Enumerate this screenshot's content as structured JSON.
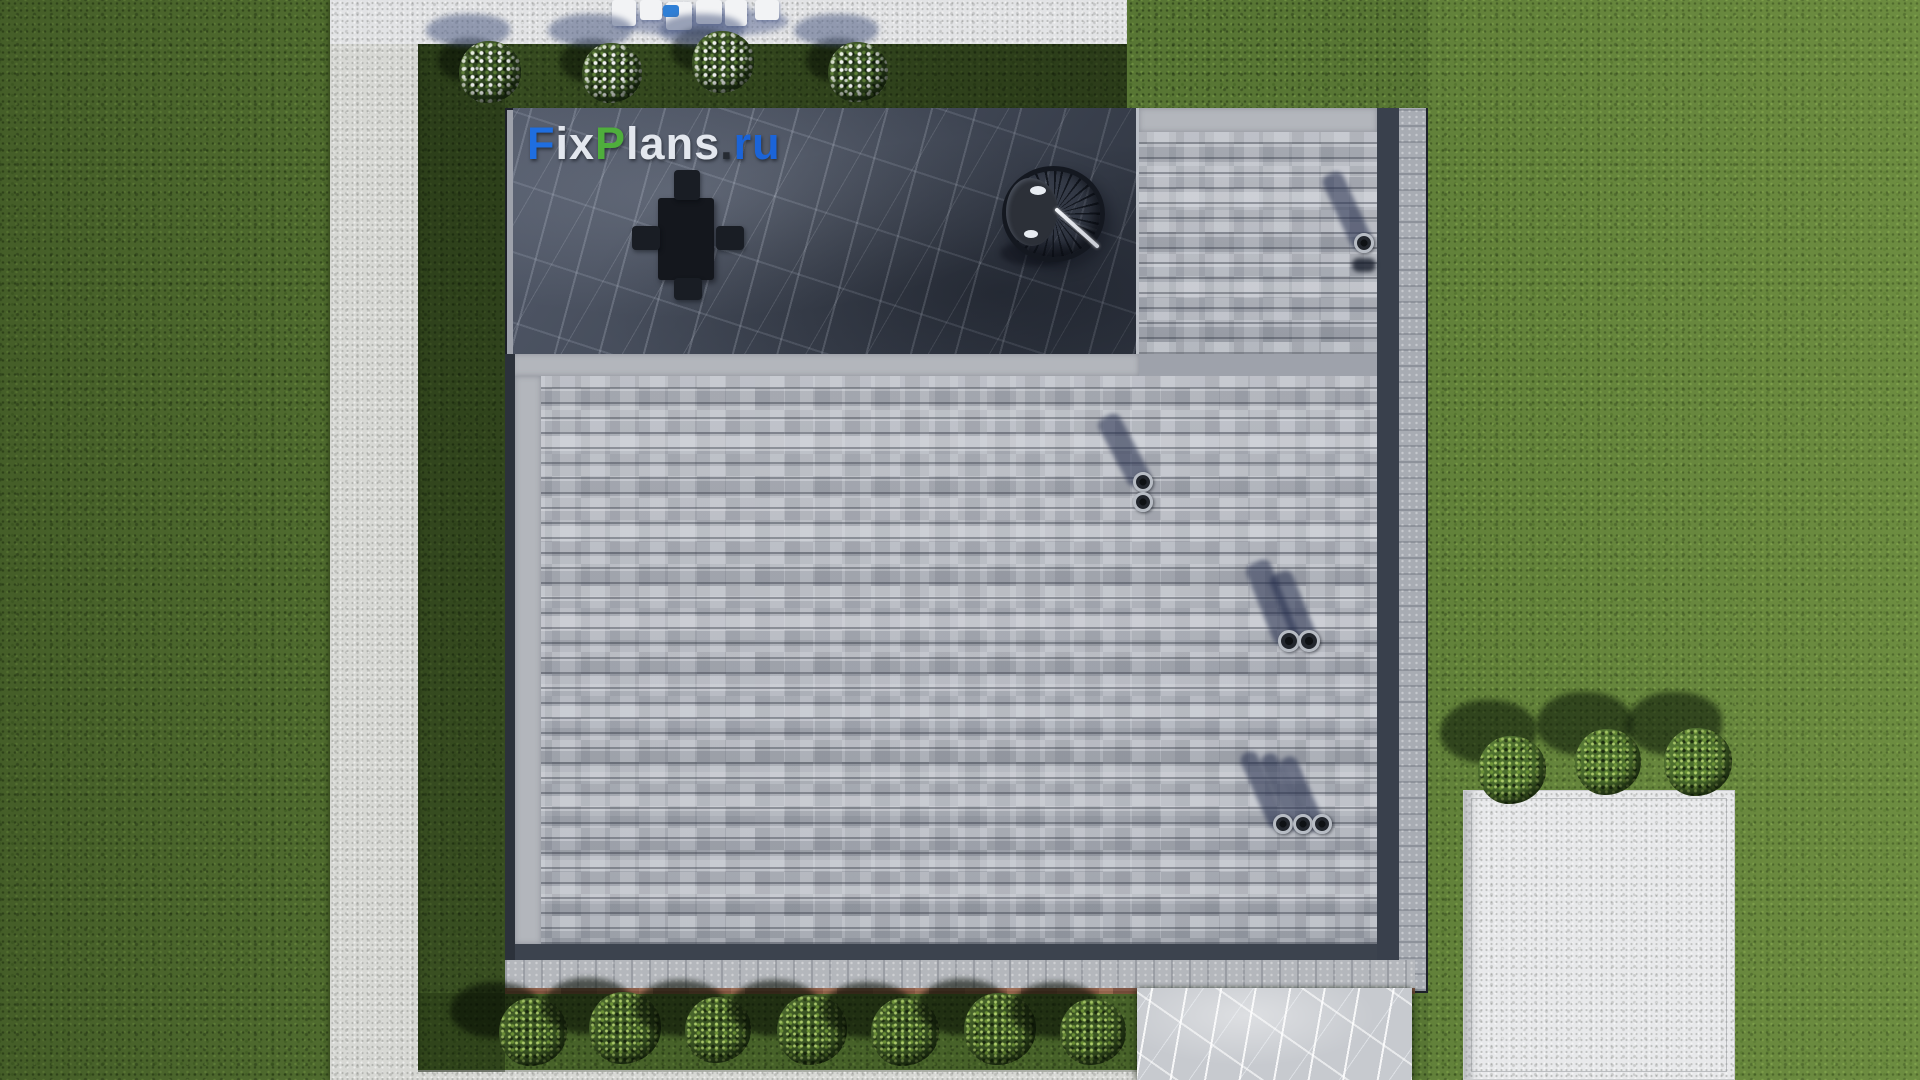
{
  "meta": {
    "description": "Aerial top-down 3D render of a house roof plan with paver roof, dark marble terrace, garden paths, lawn and shrubs",
    "source_watermark": "FixPlans.ru"
  },
  "watermark": {
    "text": "FixPlans.ru",
    "parts": [
      {
        "t": "F",
        "c": "#1f6ee0"
      },
      {
        "t": "ix",
        "c": "#e3e7ee"
      },
      {
        "t": "P",
        "c": "#4fae3c"
      },
      {
        "t": "lans",
        "c": "#e3e7ee"
      },
      {
        "t": ".",
        "c": "#262b33"
      },
      {
        "t": "ru",
        "c": "#1b64d8"
      }
    ],
    "pos": [
      527,
      118
    ]
  },
  "palette": {
    "grass": "#587634",
    "grass_bright": "#6f9440",
    "grass_shadow": "#1e2b15",
    "concrete_path": "#d7d8d4",
    "pool_deck": "#e2e3e5",
    "white_pad": "#e8e9eb",
    "paver_light": "#c2c4ca",
    "paver_mid": "#9599a2",
    "gutter_dark": "#39404c",
    "terrace_marble": "#454c5a",
    "marble_walk": "#c7cacf",
    "terracotta_edge": "#8d5a43",
    "bush_green": "#3a5423",
    "cushion_blue": "#2f7fd6"
  },
  "scene": {
    "stage": {
      "w": 1920,
      "h": 1080
    },
    "left_path": [
      330,
      0,
      88,
      1080
    ],
    "top_deck": [
      330,
      0,
      797,
      44
    ],
    "bottom_path": [
      330,
      1070,
      812,
      10
    ],
    "dark_strip_left_of_roof": [
      418,
      44,
      87,
      1028
    ],
    "dark_strip_above_roof": [
      505,
      44,
      622,
      66
    ],
    "bottom_grass_strip": [
      418,
      993,
      724,
      79
    ],
    "corner_shadow_poly": "1127px 0px, 1368px 0px, 1412px 108px, 1127px 108px",
    "roof": {
      "rect": [
        505,
        108,
        923,
        885
      ],
      "terrace": [
        513,
        108,
        626,
        246
      ],
      "terrace_margin": [
        513,
        354,
        626,
        22
      ],
      "pavers_main": [
        515,
        376,
        862,
        568
      ],
      "pavers_topright": [
        1139,
        132,
        238,
        222
      ],
      "topright_margin": [
        1139,
        108,
        238,
        24
      ],
      "left_margin": [
        515,
        376,
        26,
        568
      ],
      "seam_line": [
        1136,
        108,
        3,
        246
      ],
      "gutter_right": [
        1377,
        108,
        22,
        852
      ],
      "gutter_bottom": [
        513,
        944,
        864,
        16
      ],
      "gutter_left": [
        505,
        354,
        10,
        606
      ],
      "parapet_right": [
        1399,
        108,
        27,
        883
      ],
      "parapet_bottom": [
        505,
        960,
        910,
        28
      ],
      "terracotta_line": [
        505,
        988,
        910,
        6
      ]
    },
    "table_set": {
      "table": [
        658,
        198,
        56,
        82
      ],
      "chairs": [
        [
          674,
          170,
          26,
          30
        ],
        [
          674,
          278,
          28,
          22
        ],
        [
          632,
          226,
          28,
          24
        ],
        [
          716,
          226,
          28,
          24
        ]
      ]
    },
    "hanging_chair": {
      "ring": [
        1002,
        166,
        103,
        96
      ],
      "cushion": [
        1006,
        178,
        52,
        68
      ],
      "glints": [
        [
          1030,
          186,
          16,
          9
        ],
        [
          1024,
          230,
          14,
          8
        ]
      ],
      "pole": [
        1048,
        226,
        58,
        4,
        42
      ],
      "ground_shadow": [
        1000,
        240,
        70,
        26
      ]
    },
    "vents": [
      {
        "shadows": [
          [
            1347,
            210,
            22,
            80,
            -25
          ]
        ],
        "pipes": [
          [
            1364,
            243,
            10
          ]
        ],
        "blob": [
          1352,
          258,
          24,
          14
        ]
      },
      {
        "shadows": [
          [
            1124,
            450,
            24,
            76,
            -28
          ]
        ],
        "pipes": [
          [
            1143,
            482,
            10
          ],
          [
            1143,
            502,
            10
          ]
        ]
      },
      {
        "shadows": [
          [
            1272,
            602,
            26,
            86,
            -22
          ],
          [
            1293,
            608,
            24,
            76,
            -22
          ]
        ],
        "pipes": [
          [
            1289,
            641,
            11
          ],
          [
            1309,
            641,
            11
          ]
        ]
      },
      {
        "shadows": [
          [
            1263,
            790,
            18,
            82,
            -24
          ],
          [
            1283,
            792,
            18,
            82,
            -24
          ],
          [
            1302,
            794,
            18,
            80,
            -24
          ]
        ],
        "pipes": [
          [
            1283,
            824,
            10
          ],
          [
            1303,
            824,
            10
          ],
          [
            1322,
            824,
            10
          ]
        ]
      }
    ],
    "bushes_flowered": [
      {
        "cx": 490,
        "cy": 72,
        "r": 31
      },
      {
        "cx": 612,
        "cy": 73,
        "r": 30
      },
      {
        "cx": 723,
        "cy": 62,
        "r": 31
      },
      {
        "cx": 858,
        "cy": 72,
        "r": 30
      }
    ],
    "bushes_bottom": [
      {
        "cx": 533,
        "cy": 1032,
        "r": 34
      },
      {
        "cx": 625,
        "cy": 1028,
        "r": 36
      },
      {
        "cx": 718,
        "cy": 1030,
        "r": 33
      },
      {
        "cx": 812,
        "cy": 1030,
        "r": 35
      },
      {
        "cx": 905,
        "cy": 1032,
        "r": 34
      },
      {
        "cx": 1000,
        "cy": 1029,
        "r": 36
      },
      {
        "cx": 1093,
        "cy": 1032,
        "r": 33
      }
    ],
    "bushes_right": [
      {
        "cx": 1512,
        "cy": 770,
        "r": 34
      },
      {
        "cx": 1608,
        "cy": 762,
        "r": 33
      },
      {
        "cx": 1698,
        "cy": 762,
        "r": 34
      }
    ],
    "marble_walkway": [
      1137,
      988,
      275,
      92
    ],
    "white_pad": [
      1463,
      790,
      272,
      290
    ],
    "deck_furniture": {
      "loungers": [
        [
          612,
          0,
          24,
          26
        ],
        [
          640,
          0,
          22,
          20
        ],
        [
          666,
          2,
          26,
          28
        ],
        [
          696,
          0,
          26,
          24
        ],
        [
          725,
          0,
          22,
          26
        ],
        [
          755,
          0,
          24,
          20
        ]
      ],
      "lounger_shadow": [
        616,
        8,
        172,
        28
      ],
      "blue_cushion": [
        663,
        5,
        16,
        12
      ]
    }
  }
}
